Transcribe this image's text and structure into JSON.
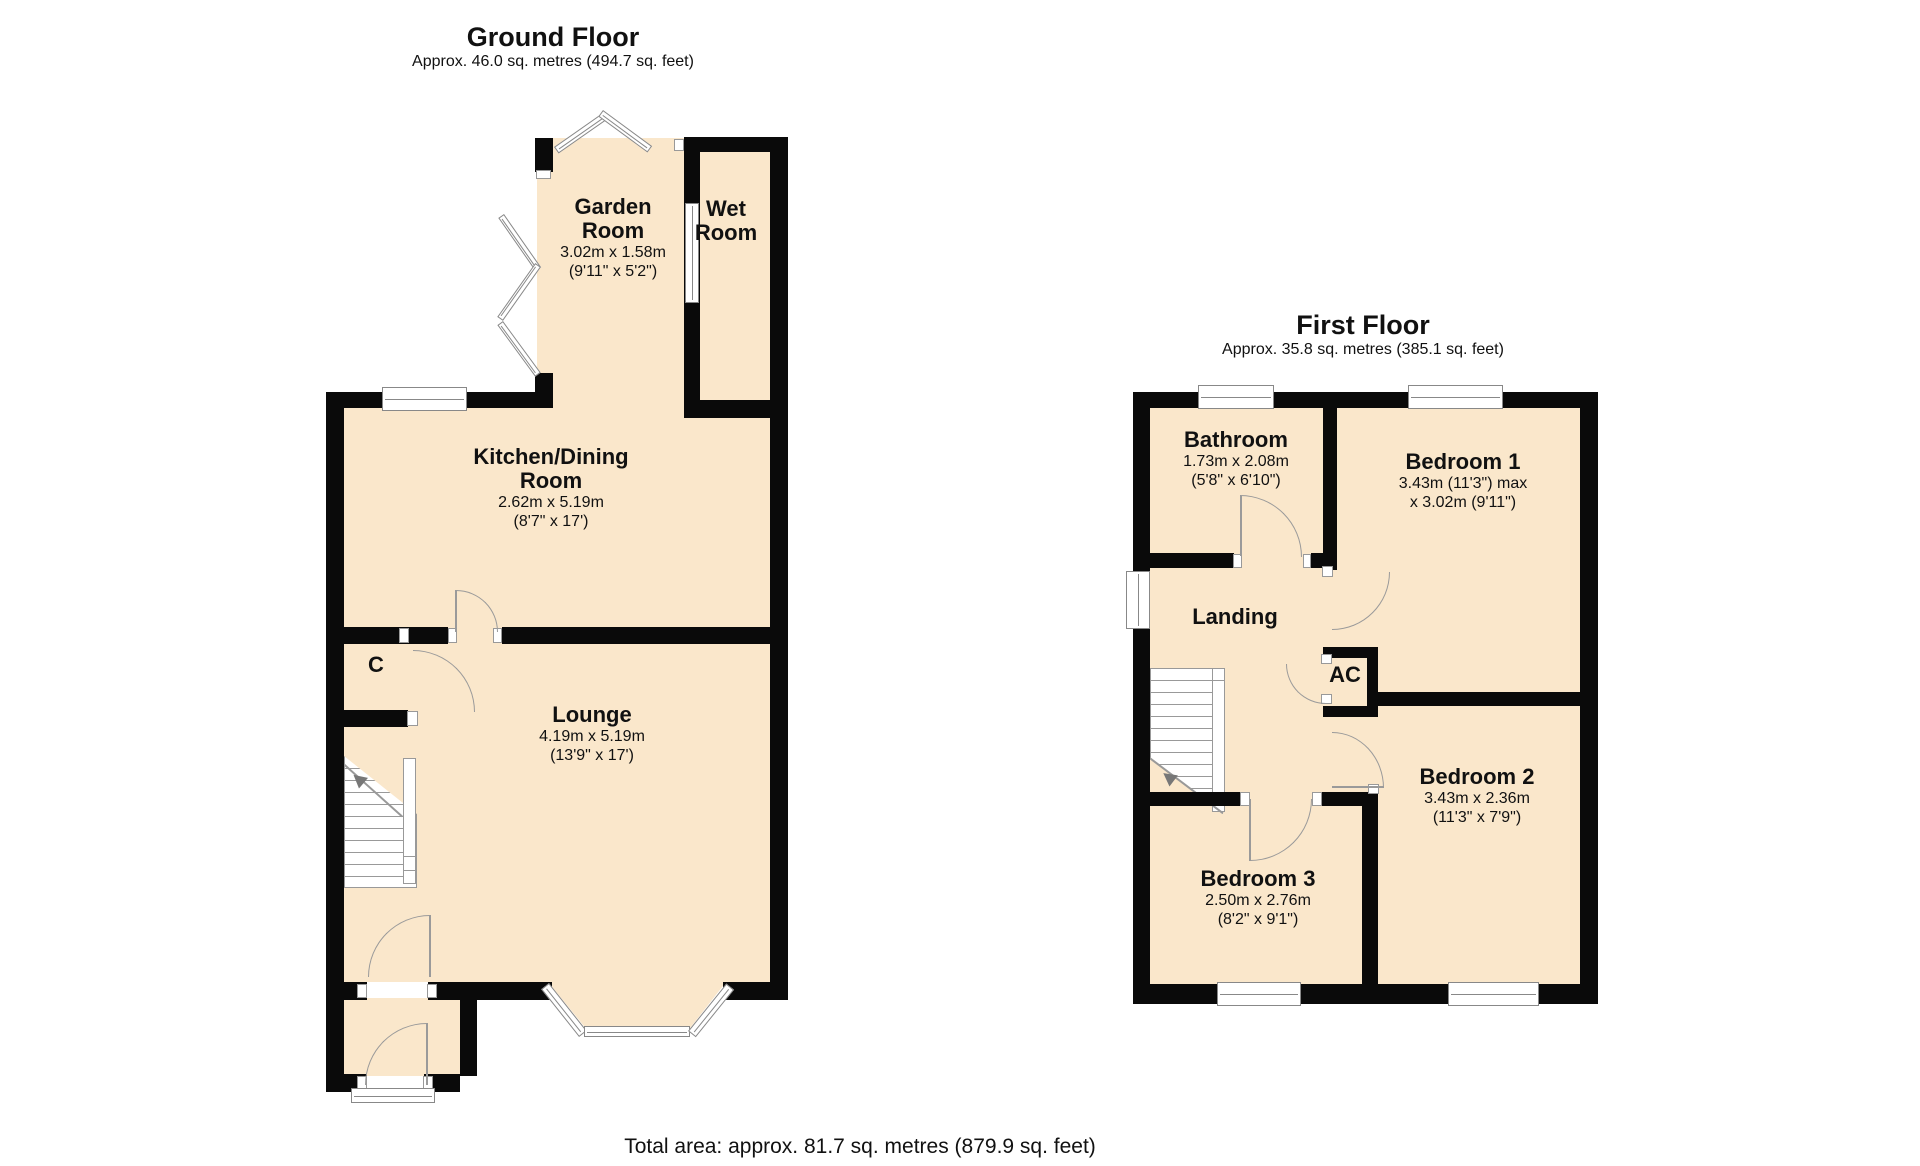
{
  "page": {
    "background": "#ffffff"
  },
  "colors": {
    "room_fill": "#FAE7CB",
    "wall": "#0A0A0A",
    "line_gray": "#8F8F8F"
  },
  "footer": {
    "total_area": "Total area: approx. 81.7 sq. metres (879.9 sq. feet)"
  },
  "ground_floor": {
    "title": "Ground Floor",
    "subtitle": "Approx. 46.0 sq. metres (494.7 sq. feet)",
    "rooms": {
      "garden_room": {
        "name": "Garden\nRoom",
        "dims_metric": "3.02m x 1.58m",
        "dims_imperial": "(9'11\" x 5'2\")"
      },
      "wet_room": {
        "name": "Wet\nRoom"
      },
      "kitchen_dining_room": {
        "name": "Kitchen/Dining\nRoom",
        "dims_metric": "2.62m x 5.19m",
        "dims_imperial": "(8'7\" x 17')"
      },
      "lounge": {
        "name": "Lounge",
        "dims_metric": "4.19m x 5.19m",
        "dims_imperial": "(13'9\" x 17')"
      },
      "cupboard": {
        "name": "C"
      }
    }
  },
  "first_floor": {
    "title": "First Floor",
    "subtitle": "Approx. 35.8 sq. metres (385.1 sq. feet)",
    "rooms": {
      "bathroom": {
        "name": "Bathroom",
        "dims_metric": "1.73m x 2.08m",
        "dims_imperial": "(5'8\" x 6'10\")"
      },
      "bedroom_1": {
        "name": "Bedroom 1",
        "dims_metric": "3.43m (11'3\") max",
        "dims_imperial": "x 3.02m (9'11\")"
      },
      "landing": {
        "name": "Landing"
      },
      "airing_cupboard": {
        "name": "AC"
      },
      "bedroom_2": {
        "name": "Bedroom 2",
        "dims_metric": "3.43m x 2.36m",
        "dims_imperial": "(11'3\" x 7'9\")"
      },
      "bedroom_3": {
        "name": "Bedroom 3",
        "dims_metric": "2.50m x 2.76m",
        "dims_imperial": "(8'2\" x 9'1\")"
      }
    }
  }
}
